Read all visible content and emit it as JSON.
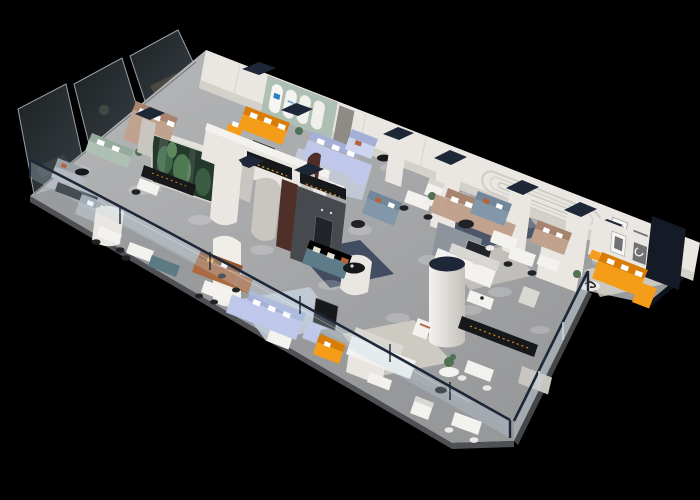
{
  "meta": {
    "description": "3D isometric cutaway render of a furniture showroom floor plan on a black background, viewed from above at an angle",
    "view": "isometric-birdseye",
    "background": "#000000"
  },
  "signage": {
    "pylon_logo": "N",
    "pylon_logo_color": "#c22030",
    "arch_logo_color": "#2e7fc1"
  },
  "palette": {
    "bg": "#000000",
    "floor": "#a6a7a9",
    "floorDeep": "#939496",
    "corridor": "#97989a",
    "edge": "#4f5054",
    "wallLit": "#eae7e2",
    "wallShade": "#c9c6c1",
    "wallDark": "#a9a6a1",
    "navy": "#1d2737",
    "navyDeep": "#141a26",
    "charcoal": "#46494e",
    "glassDark": "#23282b",
    "glassFrame": "#98a0a6",
    "railGlass": "rgba(195,215,230,0.28)",
    "orange": "#f59d18",
    "orangeDeep": "#d97d06",
    "periwinkle": "#bfc8ea",
    "periwinkleDeep": "#a5b0d8",
    "powder": "#cdd6ee",
    "sage": "#aebfb3",
    "sageDeep": "#93ab9c",
    "tan": "#c1a28e",
    "tanDeep": "#a8836e",
    "teal": "#5e7b8a",
    "tealDeep": "#4cununited6675",
    "slate": "#8297aa",
    "slateD_fix": "#72879a",
    "cognac": "#ab6a41",
    "cognacDeep": "#8f5430",
    "gray": "#b2b8be",
    "grayDeep": "#999fa6",
    "white": "#f3f2ef",
    "whiteDeep": "#d9d7d2",
    "blackFurn": "#17181a",
    "rugBlue": "#c6d0dc",
    "rugNavy": "#37445a",
    "rugCream": "#d8d4cb",
    "terrGlass": "#24382c",
    "plant": "#4e7253",
    "plantDeep": "#2f4a3a",
    "maroon": "#4f2f28",
    "logoRed": "#c22030",
    "logoBlue": "#2e7fc1",
    "artGray": "#707173"
  },
  "rooms": [
    "glass-front offices (rear left)",
    "arched gallery lounge with orange sectional",
    "periwinkle sectional showroom",
    "powder-blue sofa bay",
    "central charcoal media lounge with teal sofa",
    "rose sectional living set",
    "slate sofa bay",
    "tan sofa bay",
    "orange sectional wing (far right)",
    "cognac leather lounge",
    "white sofa studio",
    "front corridor with glass balustrade"
  ],
  "furniture": [
    "orange L sectional",
    "periwinkle L sectional",
    "powder-blue sofa",
    "sage two-seater",
    "tan sectional",
    "teal three-seater",
    "rose L sectional",
    "slate sofa",
    "tan loveseat",
    "orange wing sectional",
    "cognac leather L sofa",
    "white L sectional",
    "white armchairs",
    "glass plant terrarium",
    "round black coffee tables",
    "black media consoles",
    "white dining and desk sets",
    "cylindrical column",
    "navy-capped display pylons",
    "glass balustrade railing",
    "arched display wall",
    "brand pylon with red logo"
  ]
}
